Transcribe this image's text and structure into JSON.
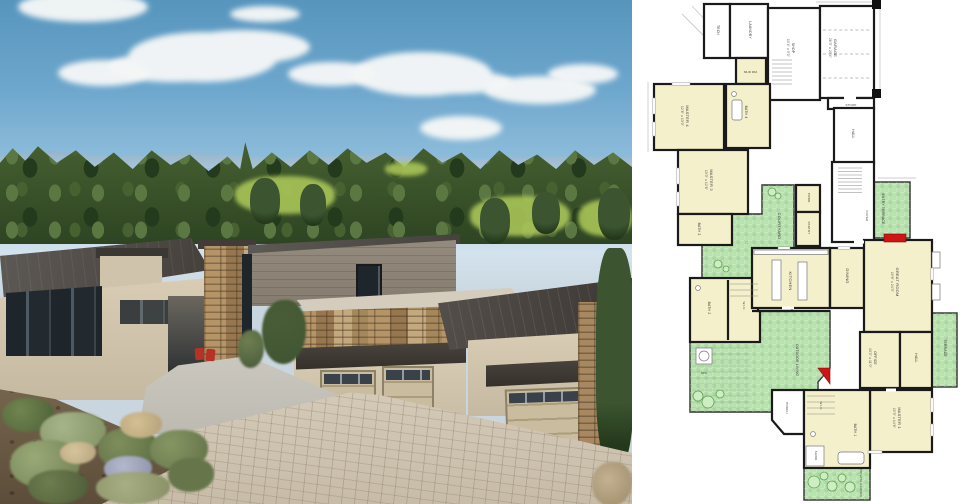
{
  "scene": {
    "left_alt": "aerial photo of a modern single-story mountain home with stone accents, metal shed roofs and three garage doors on a paver driveway, pine forest and golf course behind",
    "right_alt": "architectural first-floor plan drawing with yellow rooms, green outdoor terraces, blue water feature and red fireplaces"
  },
  "colors": {
    "sky_top": "#5795bd",
    "sky_horizon": "#bdd6e7",
    "cloud": "#f5f7f7",
    "golf_green": "#a9c557",
    "plan_room": "#f4f0cb",
    "plan_outdoor": "#b9e3ae",
    "plan_water": "#6cb0e4",
    "plan_fire": "#cf1414",
    "plan_wall": "#1a1a1a"
  },
  "plan": {
    "rooms": {
      "garage": {
        "name": "GARAGE",
        "dims": "26'0\" x 25'4\""
      },
      "tech": {
        "name": "TECH"
      },
      "laundry": {
        "name": "LAUNDRY"
      },
      "shop": {
        "name": "SHOP",
        "dims": "10'4\" x 9'0\""
      },
      "mud": {
        "name": "MUD RM."
      },
      "stoop": {
        "name": "STOOP"
      },
      "master4": {
        "name": "MASTER 4",
        "dims": "12'6\" x 13'0\""
      },
      "bath4": {
        "name": "BATH 4"
      },
      "master3": {
        "name": "MASTER 3",
        "dims": "13'0\" x 12'6\""
      },
      "bath3": {
        "name": "BATH 3"
      },
      "bath2": {
        "name": "BATH 2"
      },
      "wic2": {
        "name": "W.I.C."
      },
      "courtyard": {
        "name": "COURTYARD"
      },
      "entry_terrace": {
        "name": "ENTRY TERRACE"
      },
      "foyer": {
        "name": "FOYER"
      },
      "hall_upper": {
        "name": "HALL"
      },
      "powder": {
        "name": "PWDR."
      },
      "pantry": {
        "name": "PANTRY"
      },
      "kitchen": {
        "name": "KITCHEN"
      },
      "dining": {
        "name": "DINING"
      },
      "great_room": {
        "name": "GREAT ROOM",
        "dims": "19'6\" x 24'0\""
      },
      "outdoor_living": {
        "name": "OUTDOOR LIVING"
      },
      "spa": {
        "name": "SPA"
      },
      "office": {
        "name": "OFFICE",
        "dims": "13'2\" x 11'0\""
      },
      "hall": {
        "name": "HALL"
      },
      "terrace": {
        "name": "TERRACE"
      },
      "master1": {
        "name": "MASTER 1",
        "dims": "15'0\" x 14'6\""
      },
      "bath1": {
        "name": "BATH 1"
      },
      "wic1": {
        "name": "W.I.C."
      },
      "shower": {
        "name": "SHWR."
      },
      "porch": {
        "name": "PORCH"
      },
      "private_garden": {
        "name": "PRIVATE GARDEN"
      }
    }
  }
}
